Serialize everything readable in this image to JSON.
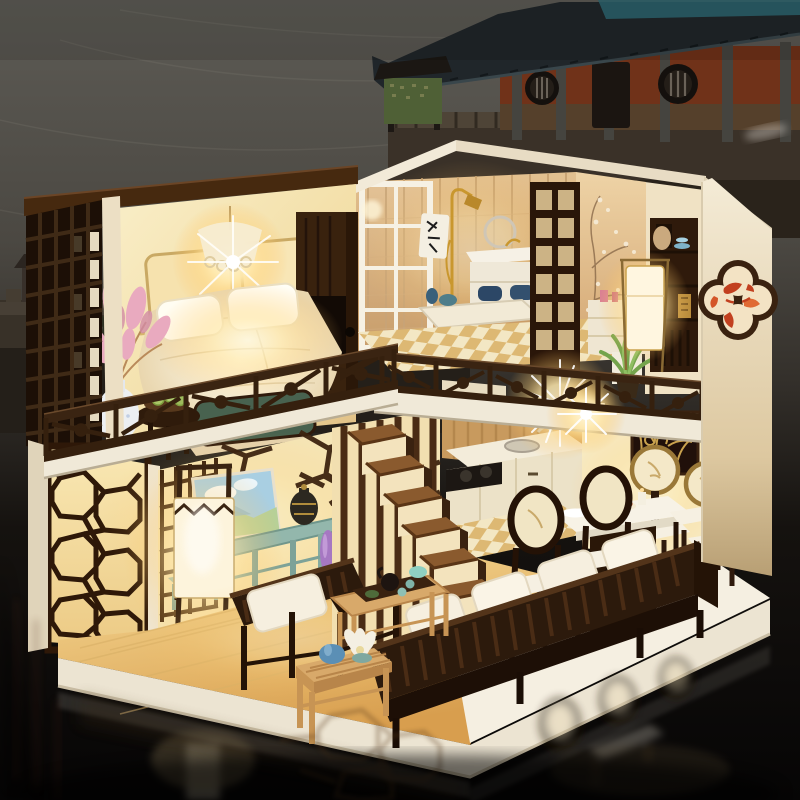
{
  "meta": {
    "type": "photograph",
    "description": "Night photo of an illuminated DIY miniature dollhouse in Chinese loft style standing on a glossy black reflective tabletop; behind it a dark backdrop with an ancient city wall and a traditional Chinese temple hall."
  },
  "scene": {
    "background": {
      "sky": "Dark overcast dusk sky with faint pale light trails",
      "city_wall": "Silhouetted ancient city wall with crenellated battlements and two watchtowers",
      "temple": "Traditional temple hall with red-orange walls, grey columns, two round slatted windows, dark door, wide dark tiled eaves with a teal ridge, on a stone terrace",
      "signboard": "Small roofed notice board with a green panel standing left of the temple"
    },
    "dollhouse": {
      "style": "Two-storey open-front miniature with warm LED lighting, dark walnut lattice work and cream walls",
      "upper_floor": {
        "bedroom": [
          "glowing lace chandelier",
          "white double bed with pillows",
          "two backlit headboard panels",
          "dark wardrobe with cutout",
          "green blanket bench",
          "round side table with plate of green fruit",
          "white speckled vase with pink flower spray",
          "dark lattice window panel on left wall"
        ],
        "bathroom": [
          "white framed shower door",
          "gold shower fixture",
          "towel with calligraphy",
          "white vanity sink with ring mirror and navy towels",
          "tan tile wall",
          "gold-and-cream checkered floor",
          "dark wooden lattice screen",
          "peach-blossom mural wall",
          "dressing desk with pink cosmetics",
          "potted green plant"
        ],
        "study_corner": [
          "dark display cabinet with blue dishes and gold book",
          "glowing rectangular paper lamp"
        ]
      },
      "ground_floor": {
        "living_room": [
          "cream wall with dark lattice and cracked-ice fretwork",
          "landscape painting of blue sky",
          "teal console table with bronze urn",
          "teal stool",
          "slender purple vase",
          "tall glowing paper floor lamp with zigzag trim",
          "dark slatted armchair and long sofa with white cushions",
          "light wood coffee table with tea tray and kettle",
          "small side table with blue pot and white lotus",
          "light wood plank floor"
        ],
        "kitchen": [
          "cream cabinets and counter with sink",
          "wood plank wall",
          "bright LED starburst light",
          "checkered floor patch"
        ],
        "dining": [
          "white dining table with dark pedestal pierced by a lit circle",
          "two near chairs with dark oval backs",
          "two far chairs with gold-ring round backs",
          "white seat cushions",
          "dark wall panel with gold branch fretwork",
          "purple vase with dried white sprigs",
          "white platform floor"
        ]
      },
      "exterior": [
        "white roof fascias",
        "cream right wall with quatrefoil koi-fish window art",
        "balcony and loft railings with diagonal fretwork",
        "octagon lattice screen on lower left corner",
        "white platform skirt"
      ]
    },
    "foreground": {
      "surface": "Glossy black tabletop mirroring the lit house, railings, lamp and dining chairs"
    }
  },
  "palette": {
    "night_sky_top": "#5d5b55",
    "night_sky_bottom": "#060505",
    "temple_wall": "#703219",
    "temple_roof": "#20262a",
    "temple_teal": "#2f6a74",
    "stone": "#3a3128",
    "house_cream": "#f1e8d4",
    "cream_shadow": "#d9cbae",
    "wood_dark": "#35200e",
    "wood_mid": "#5a3a20",
    "wood_light": "#d8a96a",
    "glow_bright": "#fff8dc",
    "glow_warm": "#ffe9ad",
    "floor_wood": "#f0cf82",
    "teal_furniture": "#8fb3a8",
    "cushion_white": "#f6efdf",
    "bench_green": "#48624f",
    "flower_pink": "#e9aabf",
    "vase_purple": "#a678c2",
    "pot_blue": "#5b8fb5",
    "koi_red": "#c2401f",
    "tile_tan": "#d9b384",
    "checker_gold": "#ddb873",
    "lamp_paper": "#fdf4dc",
    "table_black": "#0b0908"
  }
}
